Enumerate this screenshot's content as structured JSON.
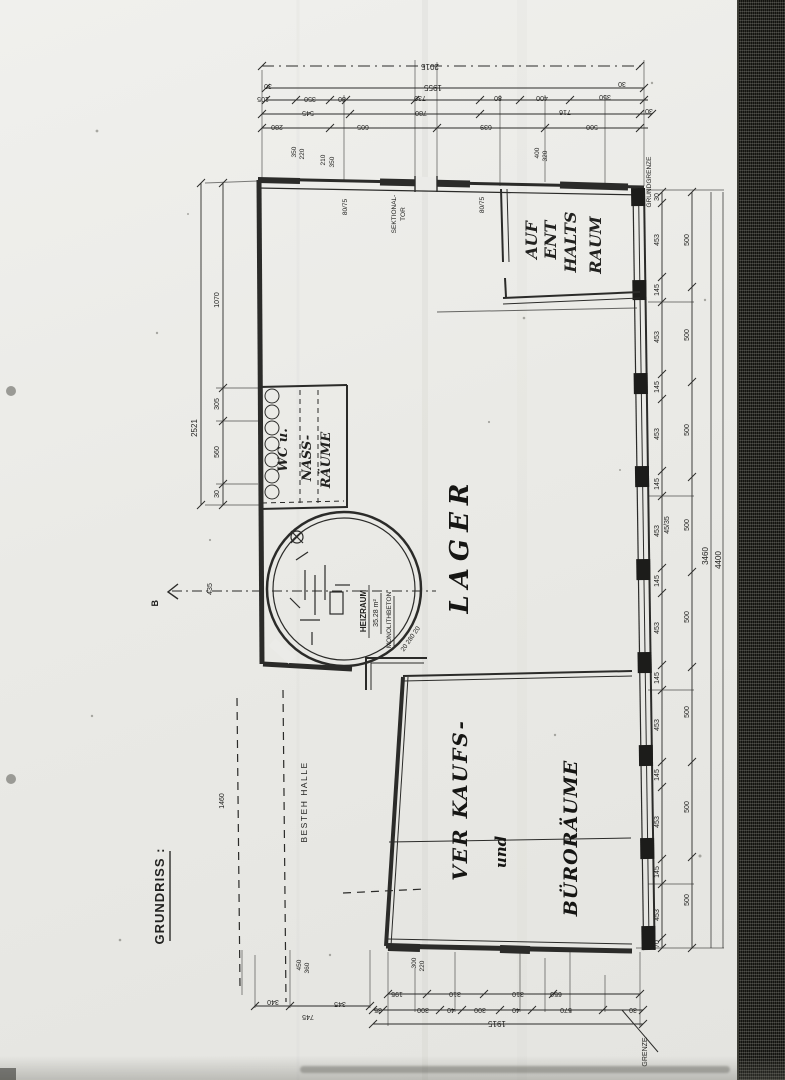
{
  "page": {
    "sheet_label": "GRUNDRISS :"
  },
  "rooms": {
    "lager": "LAGER",
    "verkauf_line1": "VER KAUFS-",
    "verkauf_line2": "und",
    "verkauf_line3": "BÜRORÄUME",
    "aufenthalt_line1": "AUF",
    "aufenthalt_line2": "ENT",
    "aufenthalt_line3": "HALTS",
    "aufenthalt_line4": "RAUM",
    "wc": "WC u.",
    "nass_line1": "NASS-",
    "nass_line2": "RÄUME",
    "heizraum": "HEIZRAUM",
    "heizraum_area": "35.28 m²",
    "heizraum_material": "MONOLITHBETON",
    "besteh_halle": "BESTEH HALLE"
  },
  "doors": {
    "sektionaltor_line1": "SEKTIONAL-",
    "sektionaltor_line2": "TOR",
    "top_door_left": "80/75",
    "top_door_right": "80/75"
  },
  "boundary": {
    "grundgrenze": "GRUNDGRENZE",
    "grenze": "GRENZE"
  },
  "notes": {
    "section_marker": "B",
    "wall_note": "45/35",
    "ring_note": "20  280  20"
  },
  "dims": {
    "top": {
      "total": "2015",
      "row2": [
        "30",
        "1955",
        "30"
      ],
      "row3": [
        "105",
        "350",
        "80",
        "730",
        "80",
        "400",
        "350"
      ],
      "row4": [
        "545",
        "780",
        "716",
        "30"
      ],
      "row5": [
        "280",
        "605",
        "639",
        "500"
      ],
      "pair1": [
        "350",
        "220"
      ],
      "pair2": [
        "210",
        "350"
      ],
      "pair3": [
        "400",
        "320"
      ]
    },
    "left": {
      "total": "2521",
      "segs": [
        "1070",
        "305",
        "560",
        "30"
      ],
      "b_dim": "435",
      "hall": "1460"
    },
    "right": {
      "chain1": [
        "30",
        "453",
        "145",
        "453",
        "145",
        "453",
        "145",
        "453",
        "145",
        "453",
        "145",
        "453",
        "145",
        "453",
        "145",
        "453",
        "70"
      ],
      "chain2": [
        "500",
        "500",
        "500",
        "500",
        "500",
        "500",
        "500",
        "500"
      ],
      "total1": "3460",
      "total2": "4400"
    },
    "bottom": {
      "pair1": [
        "450",
        "360"
      ],
      "pair2": [
        "300",
        "220"
      ],
      "row1": [
        "340",
        "345",
        "195",
        "310",
        "310",
        "650"
      ],
      "row2": [
        "35",
        "300",
        "40",
        "300",
        "40",
        "570",
        "30"
      ],
      "row3": [
        "745"
      ],
      "total": "1915"
    }
  }
}
